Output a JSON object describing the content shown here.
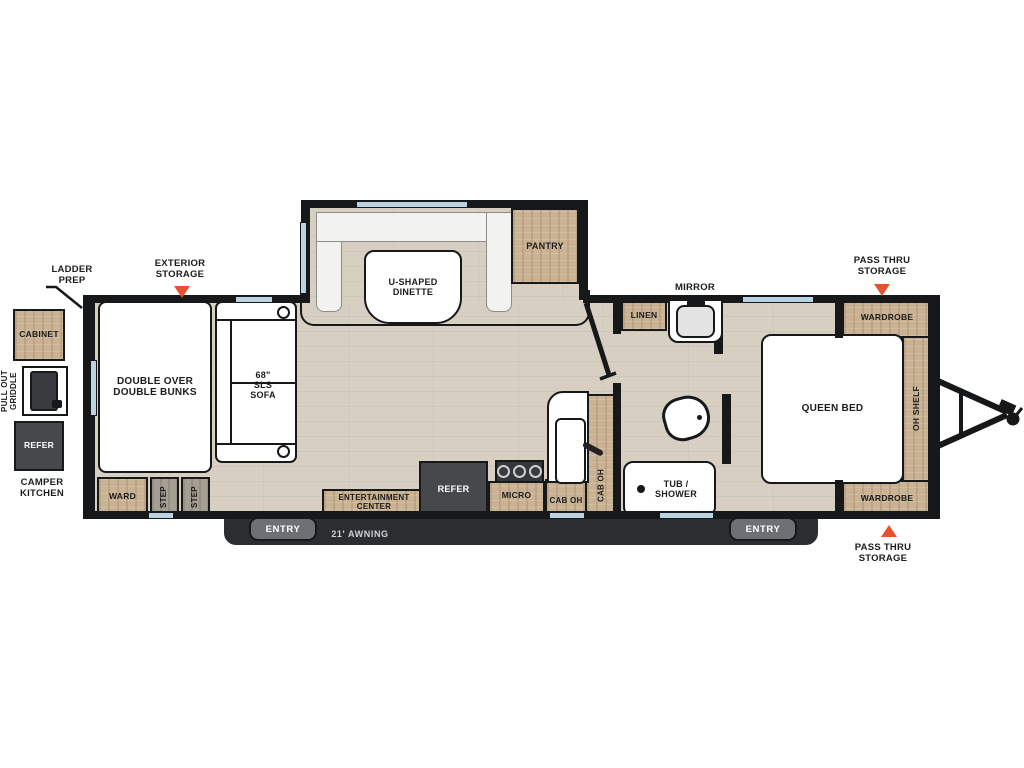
{
  "exterior": {
    "ladder_prep": "LADDER\nPREP",
    "exterior_storage": "EXTERIOR\nSTORAGE",
    "camper_kitchen": "CAMPER\nKITCHEN",
    "pass_thru_top": "PASS THRU\nSTORAGE",
    "pass_thru_bottom": "PASS THRU\nSTORAGE",
    "awning": "21' AWNING",
    "entry_left": "ENTRY",
    "entry_right": "ENTRY"
  },
  "camper_kitchen": {
    "cabinet": "CABINET",
    "griddle": "PULL OUT\nGRIDDLE",
    "refer": "REFER"
  },
  "rooms": {
    "bunks": "DOUBLE OVER\nDOUBLE BUNKS",
    "sofa": "68\"\nSLS\nSOFA",
    "dinette": "U-SHAPED\nDINETTE",
    "pantry": "PANTRY",
    "ward": "WARD",
    "step": "STEP",
    "entertainment": "ENTERTAINMENT\nCENTER",
    "refer": "REFER",
    "micro": "MICRO",
    "cab_oh": "CAB OH",
    "cab_oh_vert": "CAB OH",
    "linen": "LINEN",
    "mirror": "MIRROR",
    "tub_shower": "TUB /\nSHOWER",
    "queen_bed": "QUEEN BED",
    "oh_shelf": "OH SHELF",
    "wardrobe_top": "WARDROBE",
    "wardrobe_bottom": "WARDROBE"
  },
  "colors": {
    "accent": "#e8512e",
    "wall": "#17181a",
    "wood": "#c9b394",
    "floor": "#d6cfc2",
    "window": "#b9d3e2"
  }
}
